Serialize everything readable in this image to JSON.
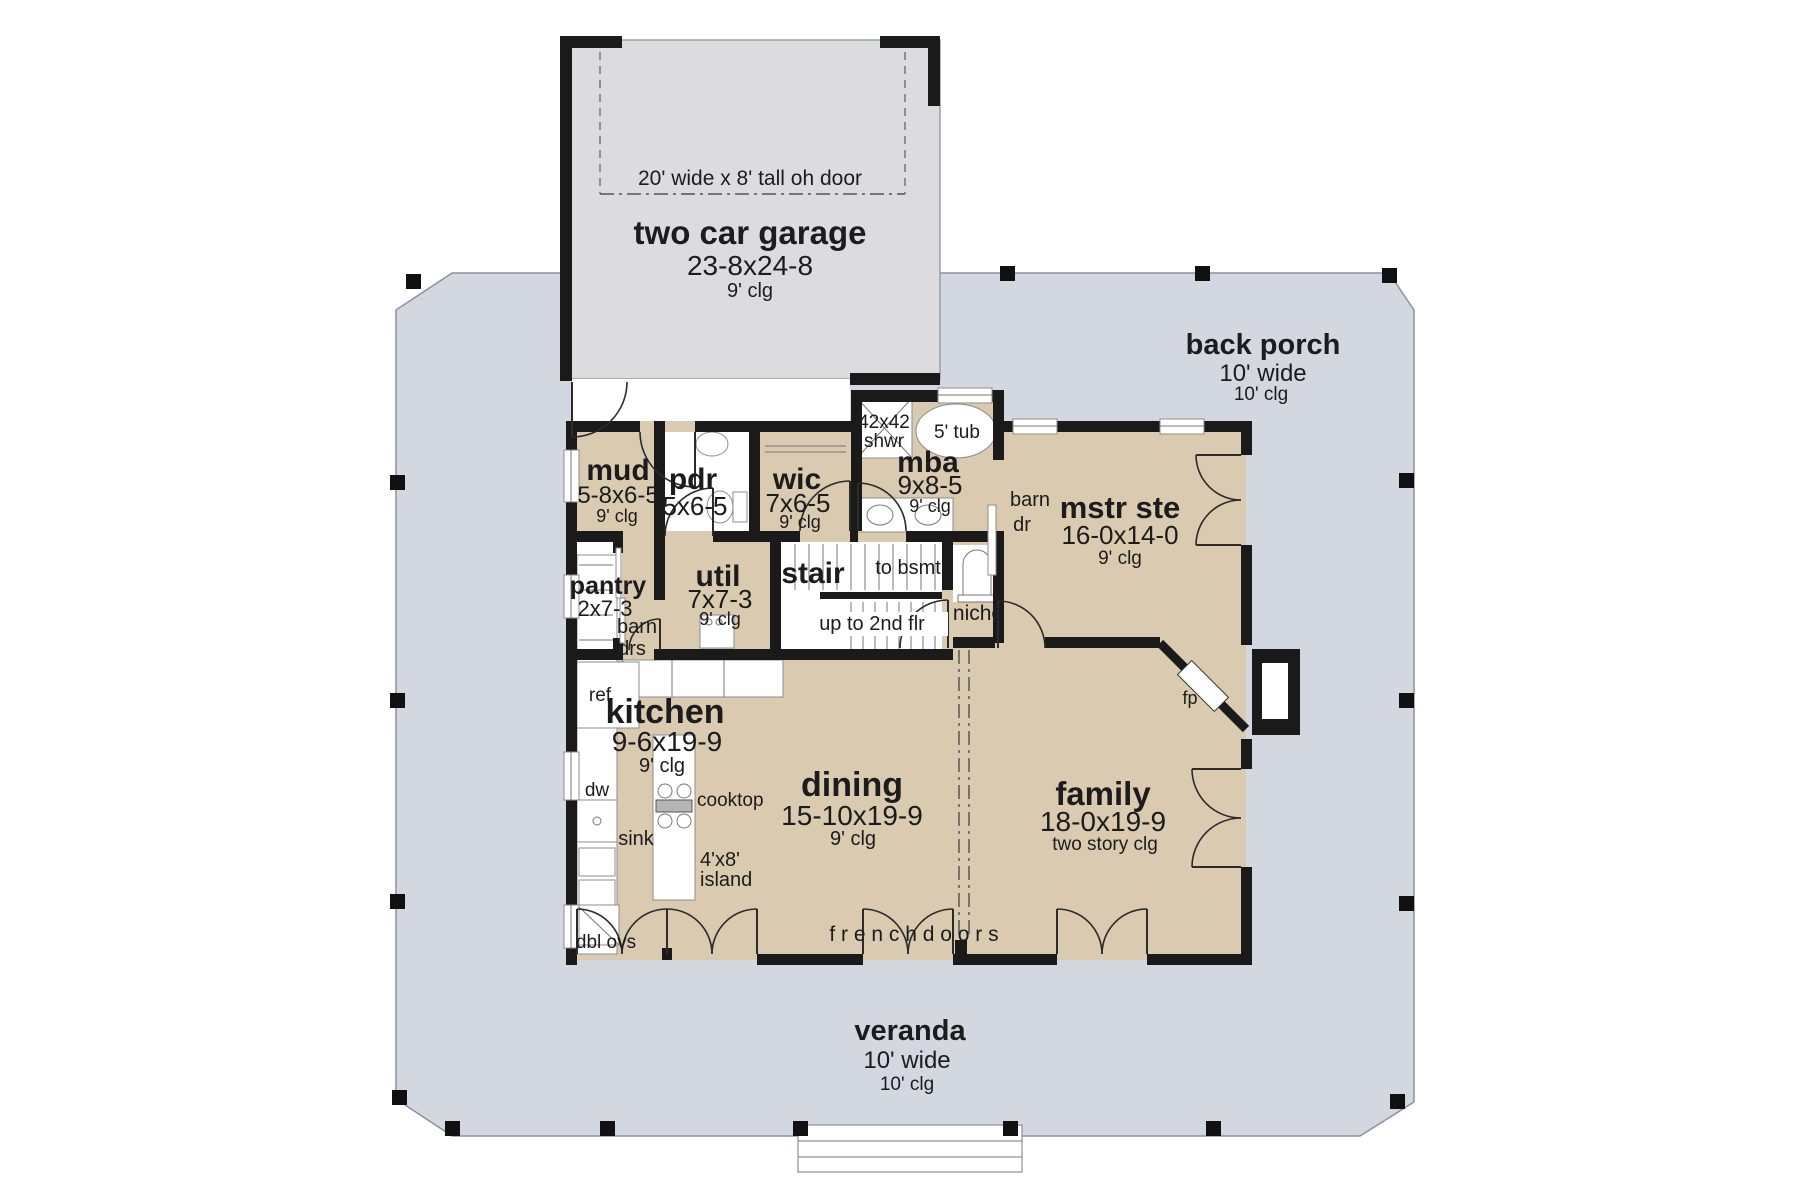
{
  "colors": {
    "porch": "#d3d7e0",
    "garage": "#dcdcde",
    "room": "#d9cab0",
    "wall": "#1a1a1a",
    "fixture_white": "#ffffff",
    "text": "#1c1c1c"
  },
  "rooms": {
    "garage": {
      "label": "two car garage",
      "dims": "23-8x24-8",
      "ceiling": "9' clg",
      "door": "20' wide x 8' tall oh door"
    },
    "back_porch": {
      "label": "back porch",
      "width": "10' wide",
      "ceiling": "10' clg"
    },
    "veranda": {
      "label": "veranda",
      "width": "10' wide",
      "ceiling": "10' clg"
    },
    "mud": {
      "label": "mud",
      "dims": "5-8x6-5",
      "ceiling": "9' clg"
    },
    "pdr": {
      "label": "pdr",
      "dims": "5x6-5"
    },
    "wic": {
      "label": "wic",
      "dims": "7x6-5",
      "ceiling": "9' clg"
    },
    "mba": {
      "label": "mba",
      "dims": "9x8-5",
      "ceiling": "9' clg"
    },
    "mstr_ste": {
      "label": "mstr ste",
      "dims": "16-0x14-0",
      "ceiling": "9' clg"
    },
    "pantry": {
      "label": "pantry",
      "dims": "2x7-3"
    },
    "util": {
      "label": "util",
      "dims": "7x7-3",
      "ceiling": "9' clg"
    },
    "stair": {
      "label": "stair",
      "to_bsmt": "to bsmt",
      "up": "up to 2nd flr"
    },
    "kitchen": {
      "label": "kitchen",
      "dims": "9-6x19-9",
      "ceiling": "9' clg"
    },
    "dining": {
      "label": "dining",
      "dims": "15-10x19-9",
      "ceiling": "9' clg"
    },
    "family": {
      "label": "family",
      "dims": "18-0x19-9",
      "ceiling": "two story clg"
    }
  },
  "fixtures": {
    "shower_size": "42x42",
    "shower": "shwr",
    "tub": "5' tub",
    "barn_door_1": "barn",
    "barn_door_2": "dr",
    "barn_doors_1": "barn",
    "barn_doors_2": "drs",
    "niche": "niche",
    "fridge": "ref",
    "dishwasher": "dw",
    "sink": "sink",
    "cooktop": "cooktop",
    "island_size": "4'x8'",
    "island": "island",
    "double_ovens": "dbl ovs",
    "fireplace": "fp",
    "french_doors": "f r e n c h   d o o r s"
  }
}
